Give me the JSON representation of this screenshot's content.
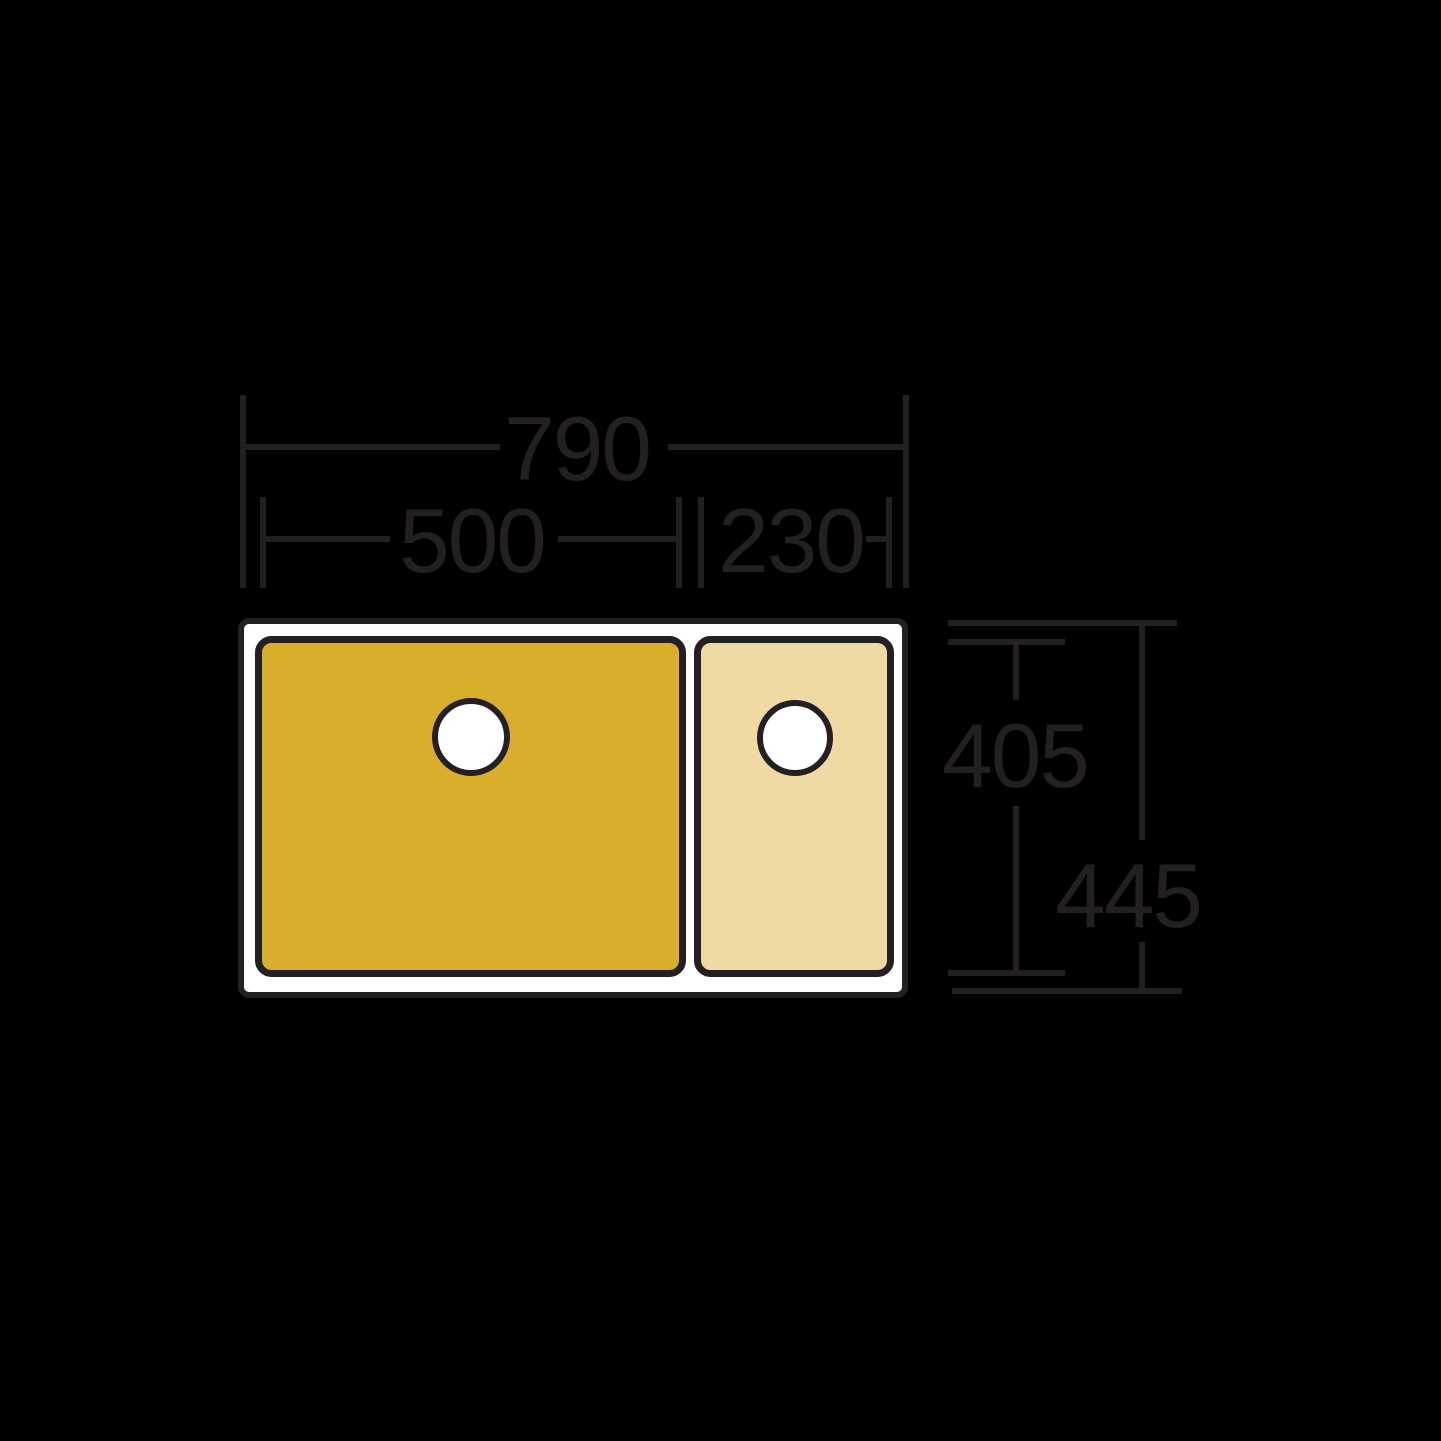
{
  "diagram": {
    "type": "technical-dimension-drawing",
    "subject": "double-bowl kitchen sink, plan view"
  },
  "colors": {
    "background": "#000000",
    "line": "#241F20",
    "rim": "#FFFFFF",
    "bowl_main": "#D9AE2B",
    "bowl_half": "#F0DAA4",
    "drain": "#FFFFFF"
  },
  "dimensions": {
    "overall_width": "790",
    "main_bowl_width": "500",
    "half_bowl_width": "230",
    "bowl_depth": "405",
    "overall_depth": "445"
  }
}
